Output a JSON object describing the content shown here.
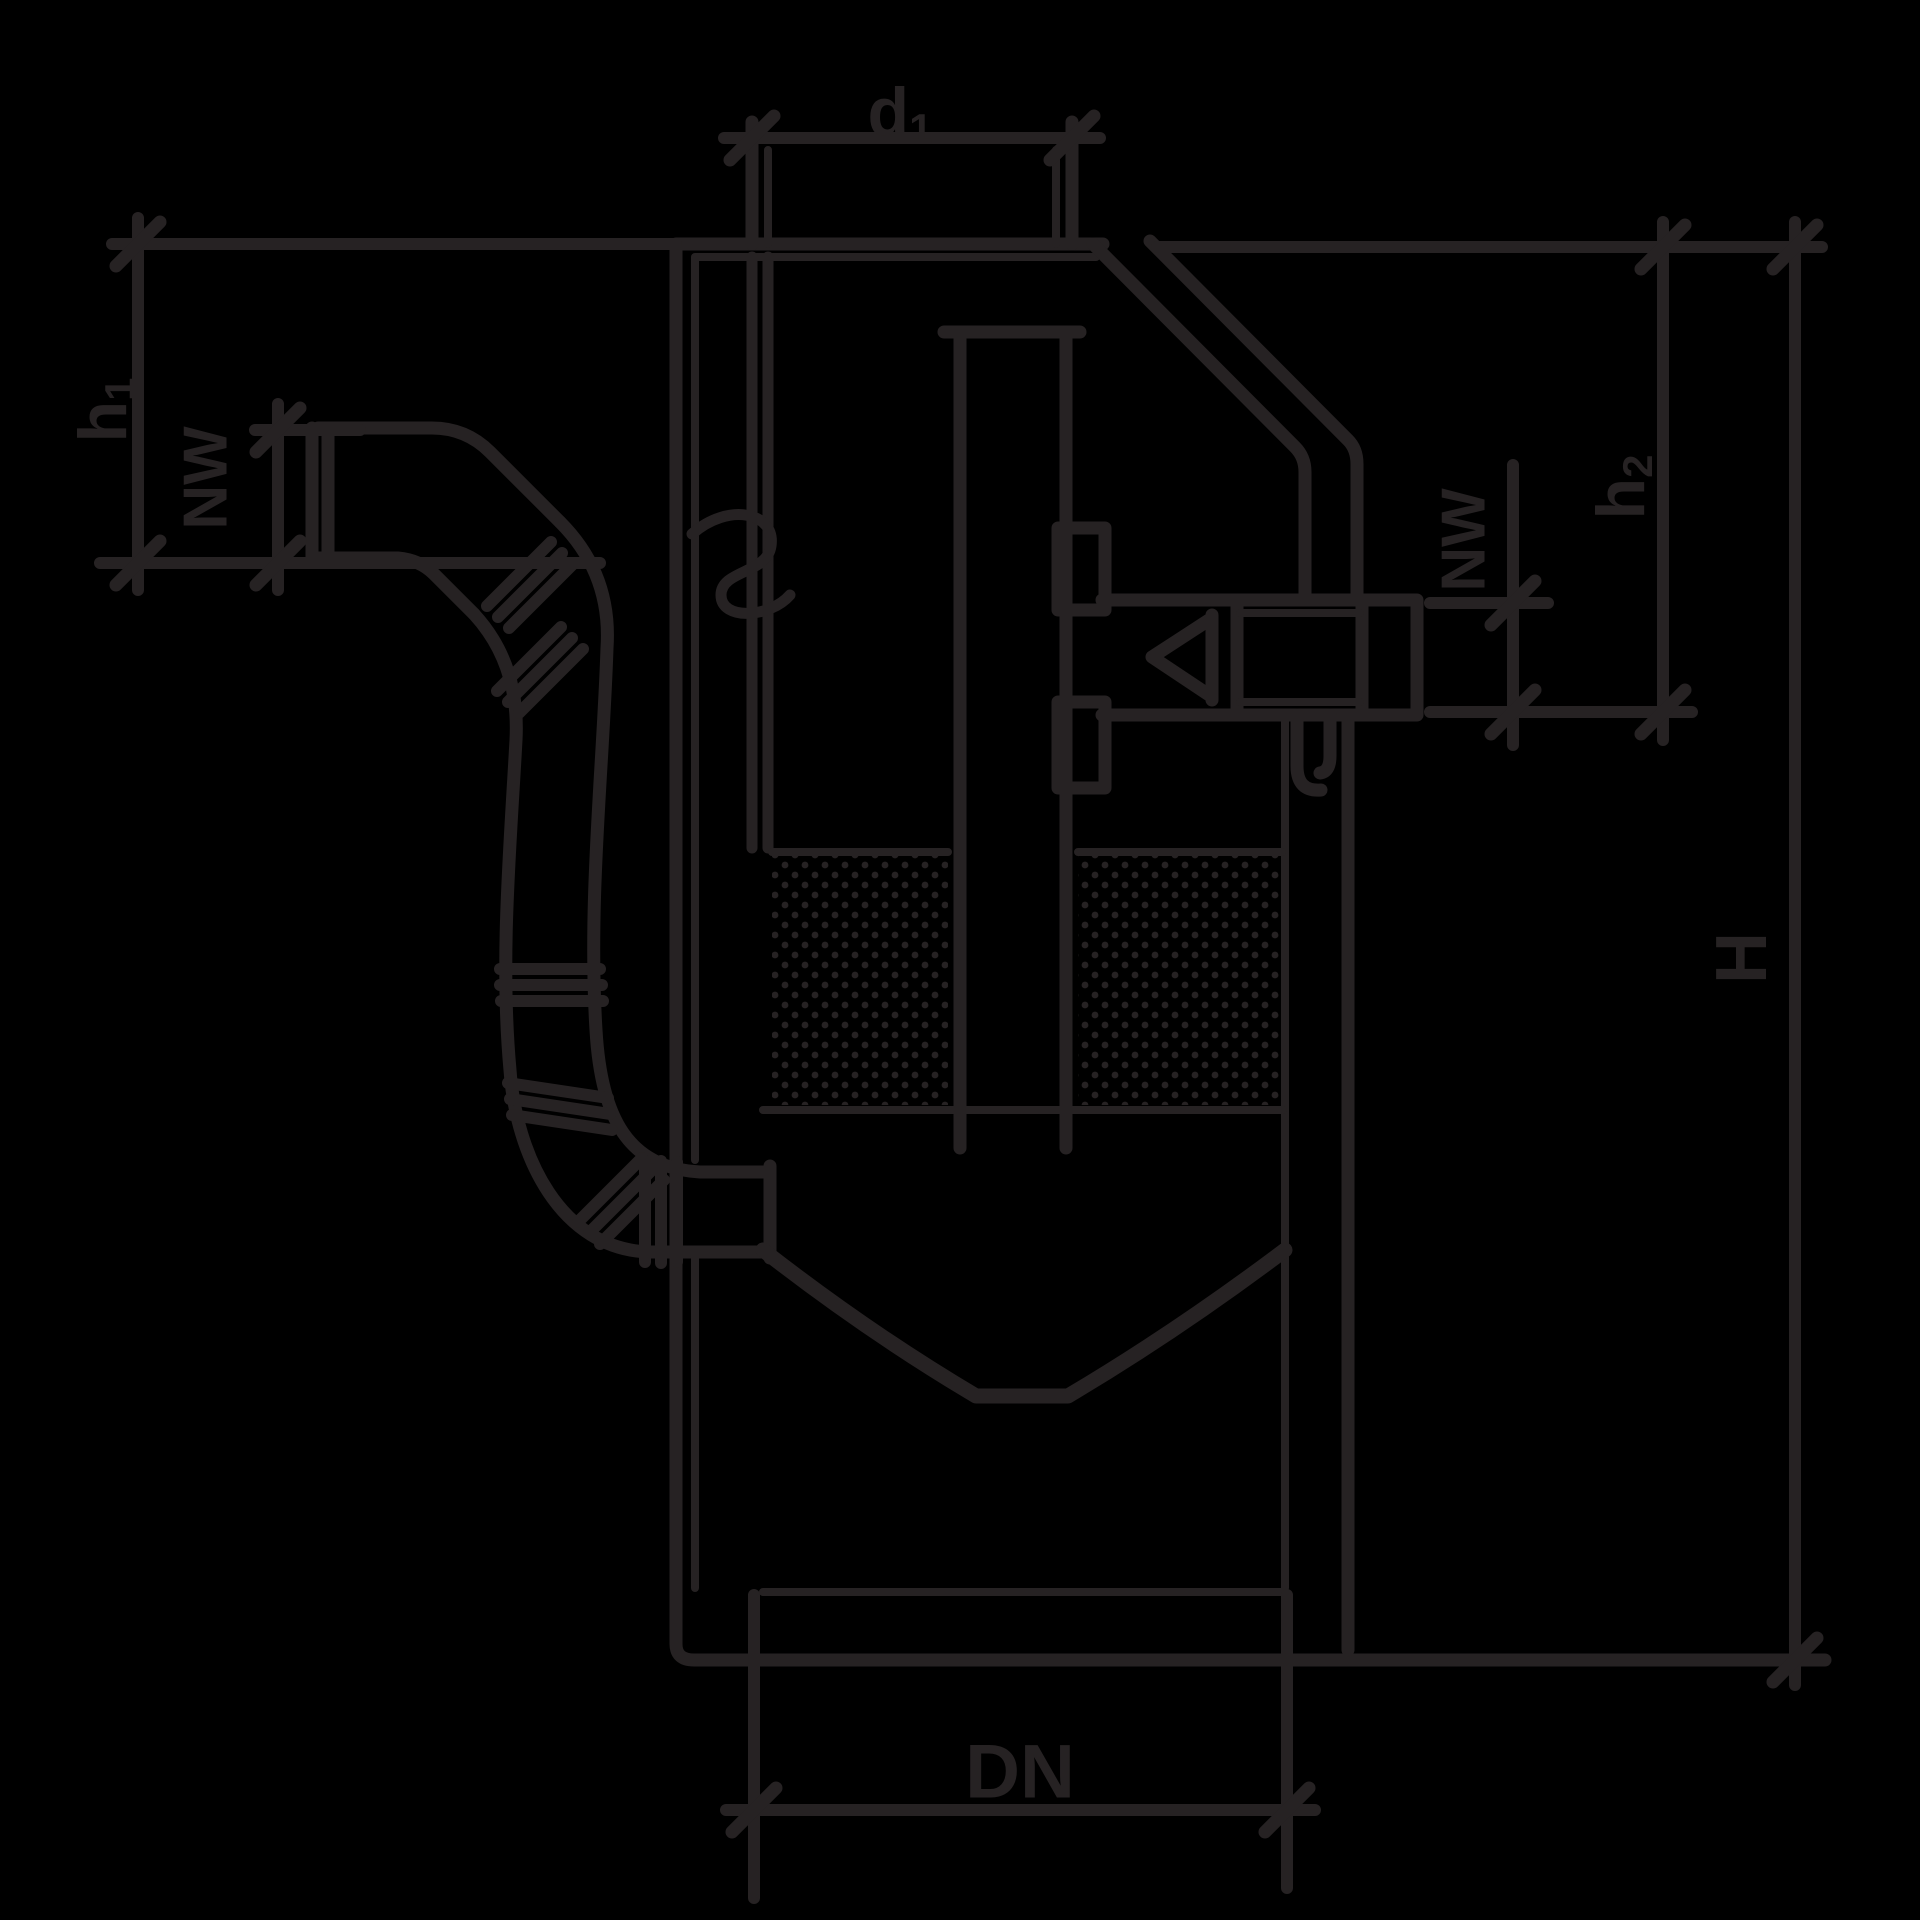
{
  "drawing": {
    "description": "black line-art technical sectional drawing of a filter shaft / separator tank with inlet elbow, flexible corrugated inlet pipe, central dip tube, filter media, check valve outlet and dimension lines",
    "colors": {
      "background": "#000000",
      "stroke": "#262223"
    },
    "labels": {
      "d1": {
        "base": "d",
        "sub": "1"
      },
      "h1": {
        "base": "h",
        "sub": "1"
      },
      "nw_left": "NW",
      "nw_right": "NW",
      "h2": {
        "base": "h",
        "sub": "2"
      },
      "H": "H",
      "DN": "DN"
    }
  }
}
